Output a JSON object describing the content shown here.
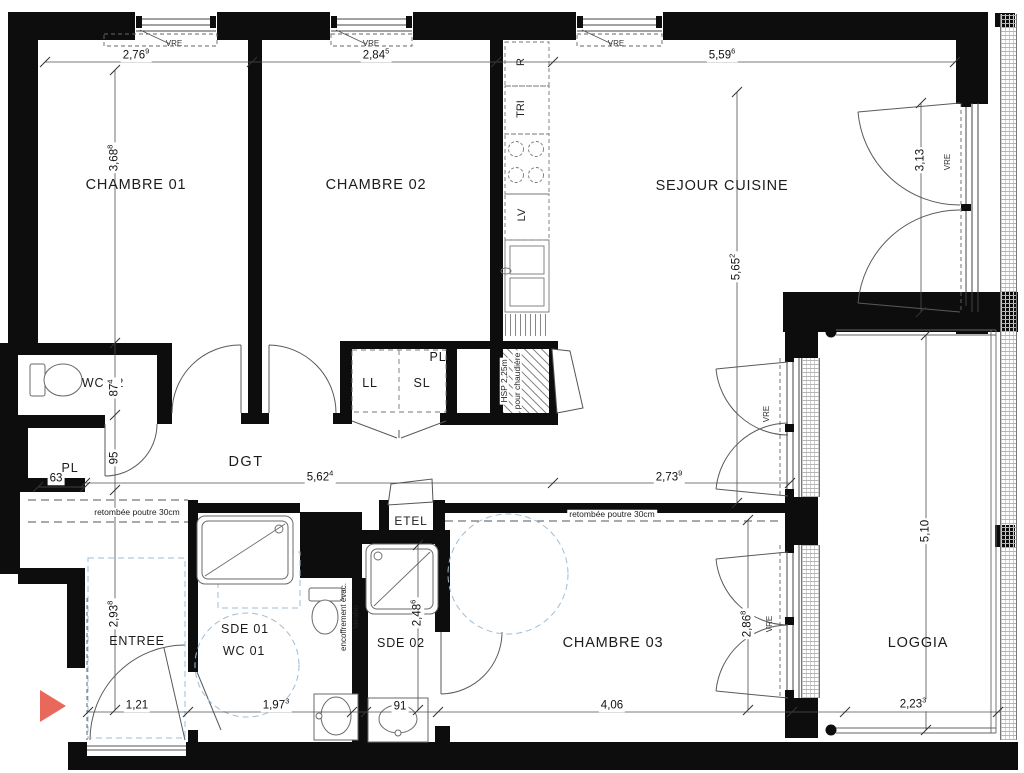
{
  "plan": {
    "rooms": {
      "chambre01": "CHAMBRE 01",
      "chambre02": "CHAMBRE 02",
      "sejour_cuisine": "SEJOUR CUISINE",
      "wc02": "WC 02",
      "dgt": "DGT",
      "entree": "ENTREE",
      "sde01": "SDE 01",
      "wc01": "WC 01",
      "sde02": "SDE 02",
      "chambre03": "CHAMBRE 03",
      "loggia": "LOGGIA"
    },
    "storage": {
      "pl": "PL",
      "ll": "LL",
      "sl": "SL",
      "etel": "ETEL"
    },
    "kitchen": {
      "r": "R",
      "tri": "TRI",
      "lv": "LV"
    },
    "window_tag": "VRE",
    "notes": {
      "beam": "retombée poutre 30cm",
      "hsp1": "HSP 2,25m",
      "hsp2": "pour chaudière",
      "enc1": "encoffrement évac.",
      "enc2": "lavabo"
    },
    "dims": {
      "ch01_w": {
        "m": "2,76",
        "s": "9"
      },
      "ch02_w": {
        "m": "2,84",
        "s": "5"
      },
      "sejour_w": {
        "m": "5,59",
        "s": "6"
      },
      "ch01_h": {
        "m": "3,68",
        "s": "8"
      },
      "sejour_h": {
        "m": "5,65",
        "s": "2"
      },
      "win_right_h": {
        "m": "3,13",
        "s": ""
      },
      "wc02_h": {
        "m": "87",
        "s": "4"
      },
      "pl_h": {
        "m": "95",
        "s": ""
      },
      "pl_w": {
        "m": "63",
        "s": ""
      },
      "dgt_w1": {
        "m": "5,62",
        "s": "4"
      },
      "dgt_w2": {
        "m": "2,73",
        "s": "9"
      },
      "entree_h": {
        "m": "2,93",
        "s": "8"
      },
      "entree_w": {
        "m": "1,21",
        "s": ""
      },
      "sde01_w": {
        "m": "1,97",
        "s": "3"
      },
      "sde02_w": {
        "m": "91",
        "s": ""
      },
      "ch03_w": {
        "m": "4,06",
        "s": ""
      },
      "sde02_h": {
        "m": "2,48",
        "s": "6"
      },
      "ch03_h": {
        "m": "2,86",
        "s": "8"
      },
      "loggia_h": {
        "m": "5,10",
        "s": ""
      },
      "loggia_w": {
        "m": "2,23",
        "s": "3"
      }
    },
    "colors": {
      "entrance_arrow": "#e8695c",
      "clearance_blue": "#9dbdd6",
      "wall": "#0d0d0d"
    }
  }
}
